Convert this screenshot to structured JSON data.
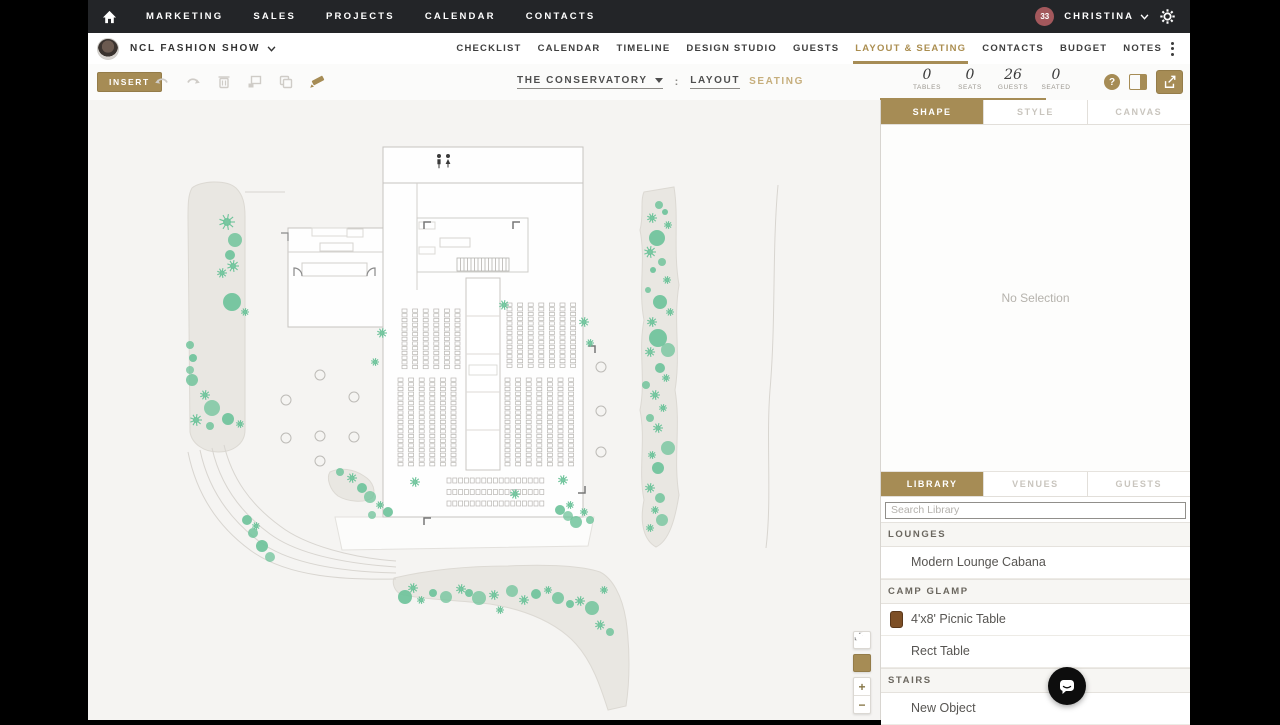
{
  "topnav": {
    "items": [
      "MARKETING",
      "SALES",
      "PROJECTS",
      "CALENDAR",
      "CONTACTS"
    ],
    "user": {
      "badge": "33",
      "name": "CHRISTINA"
    }
  },
  "eventbar": {
    "event_name": "NCL FASHION SHOW",
    "tabs": [
      {
        "label": "CHECKLIST"
      },
      {
        "label": "CALENDAR"
      },
      {
        "label": "TIMELINE"
      },
      {
        "label": "DESIGN STUDIO"
      },
      {
        "label": "GUESTS"
      },
      {
        "label": "LAYOUT & SEATING",
        "active": true
      },
      {
        "label": "CONTACTS"
      },
      {
        "label": "BUDGET"
      },
      {
        "label": "NOTES"
      }
    ]
  },
  "toolbar": {
    "insert_label": "INSERT",
    "venue_name": "THE CONSERVATORY",
    "separator": ":",
    "layout_label": "LAYOUT",
    "seating_label": "SEATING",
    "stats": [
      {
        "value": "0",
        "label": "TABLES"
      },
      {
        "value": "0",
        "label": "SEATS"
      },
      {
        "value": "26",
        "label": "GUESTS"
      },
      {
        "value": "0",
        "label": "SEATED"
      }
    ],
    "help_label": "?"
  },
  "inspector": {
    "tabs": [
      {
        "label": "SHAPE",
        "active": true
      },
      {
        "label": "STYLE"
      },
      {
        "label": "CANVAS"
      }
    ],
    "empty_text": "No Selection"
  },
  "library": {
    "tabs": [
      {
        "label": "LIBRARY",
        "active": true
      },
      {
        "label": "VENUES"
      },
      {
        "label": "GUESTS"
      }
    ],
    "search_placeholder": "Search Library",
    "rows": [
      {
        "type": "header",
        "label": "LOUNGES"
      },
      {
        "type": "item",
        "label": "Modern Lounge Cabana"
      },
      {
        "type": "header",
        "label": "CAMP GLAMP"
      },
      {
        "type": "item",
        "label": "4'x8' Picnic Table",
        "icon": "picnic-table",
        "icon_color": "#7d4f26"
      },
      {
        "type": "item",
        "label": "Rect Table"
      },
      {
        "type": "header",
        "label": "STAIRS"
      },
      {
        "type": "item",
        "label": "New Object"
      }
    ]
  },
  "zoom_controls": {
    "zoom_in": "+",
    "zoom_out": "−"
  },
  "colors": {
    "accent_gold": "#a68c55",
    "tree_green": "#6dc39a",
    "path_beige": "#e9e7e2",
    "topnav_bg": "#232528",
    "badge_maroon": "#a3585c"
  },
  "floorplan": {
    "seat_blocks": [
      {
        "x": 314,
        "y": 209,
        "cols": 6,
        "rows": 13,
        "dx": 10.6,
        "dy": 4.7,
        "w": 5,
        "h": 3.3
      },
      {
        "x": 419,
        "y": 203,
        "cols": 7,
        "rows": 14,
        "dx": 10.6,
        "dy": 4.7,
        "w": 5,
        "h": 3.3
      },
      {
        "x": 310,
        "y": 278,
        "cols": 6,
        "rows": 19,
        "dx": 10.6,
        "dy": 4.7,
        "w": 5,
        "h": 3.3
      },
      {
        "x": 417,
        "y": 278,
        "cols": 7,
        "rows": 19,
        "dx": 10.6,
        "dy": 4.7,
        "w": 5,
        "h": 3.3
      },
      {
        "x": 359,
        "y": 378,
        "cols": 17,
        "rows": 3,
        "dx": 5.8,
        "dy": 11.5,
        "w": 4,
        "h": 5
      }
    ],
    "tables": [
      {
        "x": 232,
        "y": 275
      },
      {
        "x": 198,
        "y": 300
      },
      {
        "x": 266,
        "y": 297
      },
      {
        "x": 198,
        "y": 338
      },
      {
        "x": 232,
        "y": 336
      },
      {
        "x": 266,
        "y": 337
      },
      {
        "x": 232,
        "y": 361
      },
      {
        "x": 513,
        "y": 267
      },
      {
        "x": 513,
        "y": 311
      },
      {
        "x": 513,
        "y": 352
      }
    ],
    "trees": [
      {
        "t": "b",
        "x": 139,
        "y": 122,
        "r": 8
      },
      {
        "t": "c",
        "x": 147,
        "y": 140,
        "r": 7
      },
      {
        "t": "c",
        "x": 142,
        "y": 155,
        "r": 5
      },
      {
        "t": "b",
        "x": 145,
        "y": 166,
        "r": 6
      },
      {
        "t": "b",
        "x": 134,
        "y": 173,
        "r": 5
      },
      {
        "t": "c",
        "x": 144,
        "y": 202,
        "r": 9
      },
      {
        "t": "b",
        "x": 157,
        "y": 212,
        "r": 4
      },
      {
        "t": "c",
        "x": 102,
        "y": 245,
        "r": 4
      },
      {
        "t": "c",
        "x": 105,
        "y": 258,
        "r": 4
      },
      {
        "t": "c",
        "x": 102,
        "y": 270,
        "r": 4
      },
      {
        "t": "c",
        "x": 104,
        "y": 280,
        "r": 6
      },
      {
        "t": "b",
        "x": 117,
        "y": 295,
        "r": 5
      },
      {
        "t": "c",
        "x": 124,
        "y": 308,
        "r": 8
      },
      {
        "t": "b",
        "x": 108,
        "y": 320,
        "r": 6
      },
      {
        "t": "c",
        "x": 140,
        "y": 319,
        "r": 6
      },
      {
        "t": "b",
        "x": 152,
        "y": 324,
        "r": 4
      },
      {
        "t": "c",
        "x": 122,
        "y": 326,
        "r": 4
      },
      {
        "t": "c",
        "x": 159,
        "y": 420,
        "r": 5
      },
      {
        "t": "b",
        "x": 168,
        "y": 426,
        "r": 4
      },
      {
        "t": "c",
        "x": 165,
        "y": 433,
        "r": 5
      },
      {
        "t": "c",
        "x": 174,
        "y": 446,
        "r": 6
      },
      {
        "t": "c",
        "x": 182,
        "y": 457,
        "r": 5
      },
      {
        "t": "b",
        "x": 264,
        "y": 378,
        "r": 5
      },
      {
        "t": "c",
        "x": 274,
        "y": 388,
        "r": 5
      },
      {
        "t": "c",
        "x": 282,
        "y": 397,
        "r": 6
      },
      {
        "t": "b",
        "x": 292,
        "y": 405,
        "r": 4
      },
      {
        "t": "c",
        "x": 300,
        "y": 412,
        "r": 5
      },
      {
        "t": "c",
        "x": 284,
        "y": 415,
        "r": 4
      },
      {
        "t": "c",
        "x": 252,
        "y": 372,
        "r": 4
      },
      {
        "t": "b",
        "x": 327,
        "y": 382,
        "r": 5
      },
      {
        "t": "b",
        "x": 427,
        "y": 394,
        "r": 5
      },
      {
        "t": "b",
        "x": 475,
        "y": 380,
        "r": 5
      },
      {
        "t": "c",
        "x": 472,
        "y": 410,
        "r": 5
      },
      {
        "t": "c",
        "x": 480,
        "y": 416,
        "r": 5
      },
      {
        "t": "c",
        "x": 488,
        "y": 422,
        "r": 6
      },
      {
        "t": "b",
        "x": 496,
        "y": 412,
        "r": 4
      },
      {
        "t": "b",
        "x": 482,
        "y": 405,
        "r": 4
      },
      {
        "t": "c",
        "x": 502,
        "y": 420,
        "r": 4
      },
      {
        "t": "b",
        "x": 294,
        "y": 233,
        "r": 5
      },
      {
        "t": "b",
        "x": 287,
        "y": 262,
        "r": 4
      },
      {
        "t": "b",
        "x": 416,
        "y": 205,
        "r": 5
      },
      {
        "t": "b",
        "x": 496,
        "y": 222,
        "r": 5
      },
      {
        "t": "b",
        "x": 502,
        "y": 243,
        "r": 4
      },
      {
        "t": "c",
        "x": 571,
        "y": 105,
        "r": 4
      },
      {
        "t": "c",
        "x": 577,
        "y": 112,
        "r": 3
      },
      {
        "t": "b",
        "x": 564,
        "y": 118,
        "r": 5
      },
      {
        "t": "b",
        "x": 580,
        "y": 125,
        "r": 4
      },
      {
        "t": "c",
        "x": 569,
        "y": 138,
        "r": 8
      },
      {
        "t": "b",
        "x": 562,
        "y": 152,
        "r": 6
      },
      {
        "t": "c",
        "x": 574,
        "y": 162,
        "r": 4
      },
      {
        "t": "c",
        "x": 565,
        "y": 170,
        "r": 3
      },
      {
        "t": "b",
        "x": 579,
        "y": 180,
        "r": 4
      },
      {
        "t": "c",
        "x": 560,
        "y": 190,
        "r": 3
      },
      {
        "t": "c",
        "x": 572,
        "y": 202,
        "r": 7
      },
      {
        "t": "b",
        "x": 582,
        "y": 212,
        "r": 4
      },
      {
        "t": "b",
        "x": 564,
        "y": 222,
        "r": 5
      },
      {
        "t": "c",
        "x": 570,
        "y": 238,
        "r": 9
      },
      {
        "t": "c",
        "x": 580,
        "y": 250,
        "r": 7
      },
      {
        "t": "b",
        "x": 562,
        "y": 252,
        "r": 5
      },
      {
        "t": "c",
        "x": 572,
        "y": 268,
        "r": 5
      },
      {
        "t": "b",
        "x": 578,
        "y": 278,
        "r": 4
      },
      {
        "t": "c",
        "x": 558,
        "y": 285,
        "r": 4
      },
      {
        "t": "b",
        "x": 567,
        "y": 295,
        "r": 5
      },
      {
        "t": "b",
        "x": 575,
        "y": 308,
        "r": 4
      },
      {
        "t": "c",
        "x": 562,
        "y": 318,
        "r": 4
      },
      {
        "t": "b",
        "x": 570,
        "y": 328,
        "r": 5
      },
      {
        "t": "c",
        "x": 580,
        "y": 348,
        "r": 7
      },
      {
        "t": "b",
        "x": 564,
        "y": 355,
        "r": 4
      },
      {
        "t": "c",
        "x": 570,
        "y": 368,
        "r": 6
      },
      {
        "t": "b",
        "x": 562,
        "y": 388,
        "r": 5
      },
      {
        "t": "c",
        "x": 572,
        "y": 398,
        "r": 5
      },
      {
        "t": "b",
        "x": 567,
        "y": 410,
        "r": 4
      },
      {
        "t": "c",
        "x": 574,
        "y": 420,
        "r": 6
      },
      {
        "t": "b",
        "x": 562,
        "y": 428,
        "r": 4
      },
      {
        "t": "c",
        "x": 317,
        "y": 497,
        "r": 7
      },
      {
        "t": "b",
        "x": 325,
        "y": 488,
        "r": 5
      },
      {
        "t": "b",
        "x": 333,
        "y": 500,
        "r": 4
      },
      {
        "t": "c",
        "x": 345,
        "y": 493,
        "r": 4
      },
      {
        "t": "c",
        "x": 358,
        "y": 497,
        "r": 6
      },
      {
        "t": "b",
        "x": 373,
        "y": 489,
        "r": 5
      },
      {
        "t": "c",
        "x": 381,
        "y": 493,
        "r": 4
      },
      {
        "t": "c",
        "x": 391,
        "y": 498,
        "r": 7
      },
      {
        "t": "b",
        "x": 406,
        "y": 495,
        "r": 5
      },
      {
        "t": "b",
        "x": 412,
        "y": 510,
        "r": 4
      },
      {
        "t": "c",
        "x": 424,
        "y": 491,
        "r": 6
      },
      {
        "t": "b",
        "x": 436,
        "y": 500,
        "r": 5
      },
      {
        "t": "c",
        "x": 448,
        "y": 494,
        "r": 5
      },
      {
        "t": "b",
        "x": 460,
        "y": 490,
        "r": 4
      },
      {
        "t": "c",
        "x": 470,
        "y": 498,
        "r": 6
      },
      {
        "t": "c",
        "x": 482,
        "y": 504,
        "r": 4
      },
      {
        "t": "b",
        "x": 492,
        "y": 501,
        "r": 5
      },
      {
        "t": "c",
        "x": 504,
        "y": 508,
        "r": 7
      },
      {
        "t": "b",
        "x": 516,
        "y": 490,
        "r": 4
      },
      {
        "t": "b",
        "x": 512,
        "y": 525,
        "r": 5
      },
      {
        "t": "c",
        "x": 522,
        "y": 532,
        "r": 4
      }
    ]
  }
}
